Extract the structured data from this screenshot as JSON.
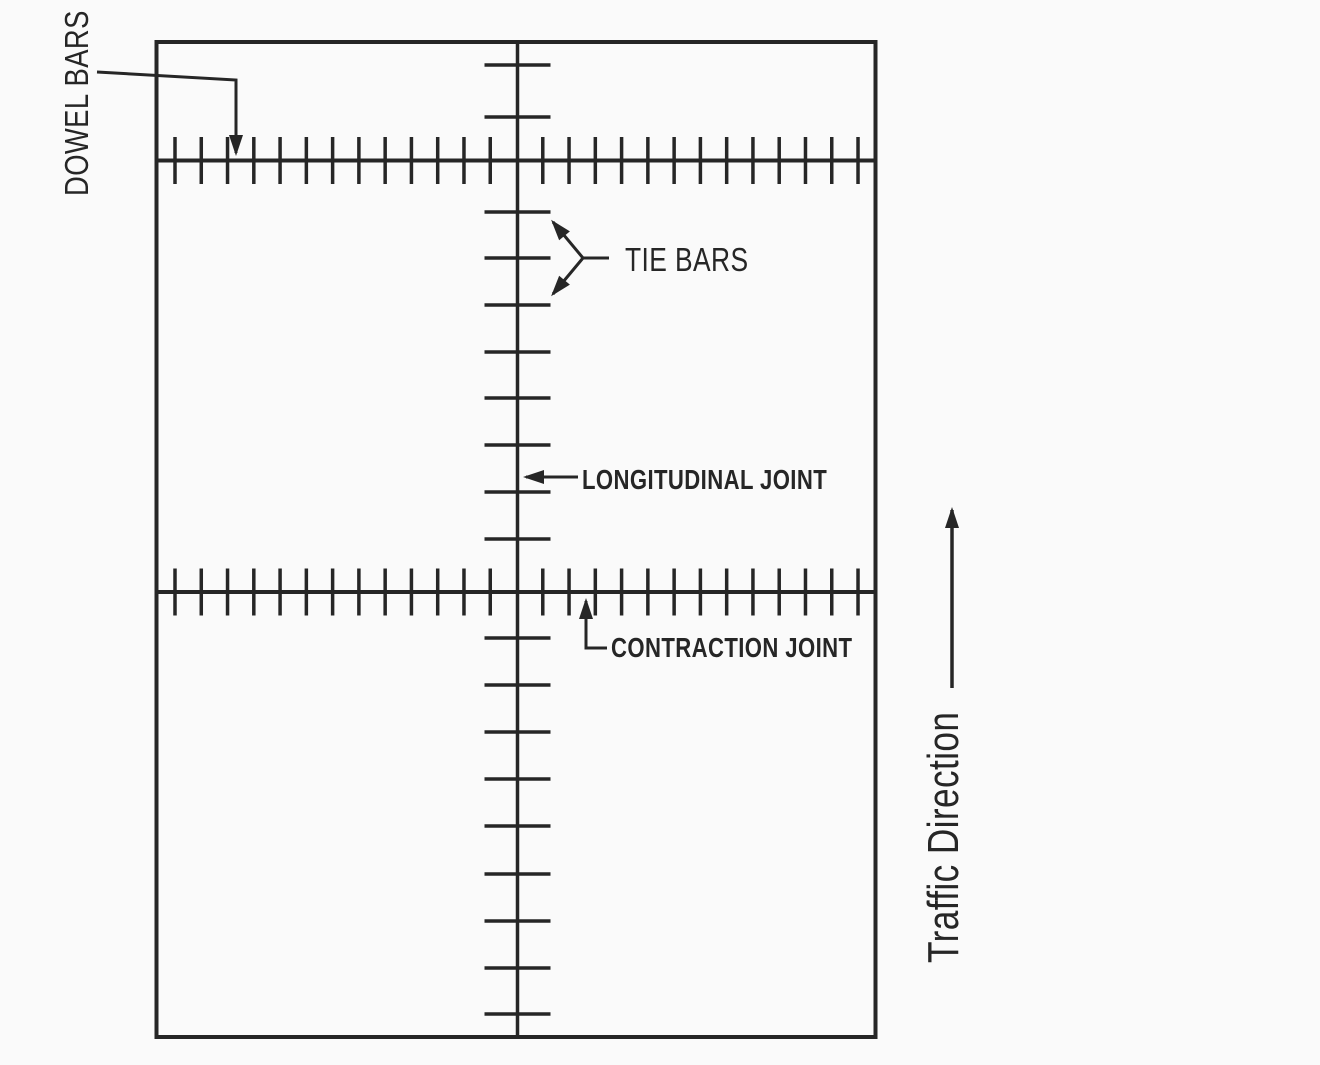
{
  "figure": {
    "type": "jointed-concrete-pavement-plan-diagram",
    "labels": {
      "dowel_bars": "DOWEL BARS",
      "tie_bars": "TIE BARS",
      "longitudinal_joint": "LONGITUDINAL JOINT",
      "contraction_joint": "CONTRACTION JOINT",
      "traffic_direction": "Traffic Direction"
    },
    "colors": {
      "ink": "#262626",
      "background": "#fafafa"
    },
    "geometry": {
      "slab": {
        "x": 156.5,
        "y": 42,
        "width": 719,
        "height": 995
      },
      "longitudinal_joint_x": 517.5,
      "contraction_joint_ys": [
        160.5,
        592
      ],
      "dowel_ticks": {
        "first_x": 175,
        "spacing": 26.27,
        "count": 27,
        "skip_index": 13,
        "half_length": 23.5
      },
      "tie_bars": {
        "ys": [
          65,
          117,
          212,
          258,
          305,
          352,
          398,
          445,
          492,
          539,
          638,
          685,
          732,
          779,
          826,
          874,
          921,
          968,
          1014
        ],
        "half_length": 33
      }
    }
  }
}
